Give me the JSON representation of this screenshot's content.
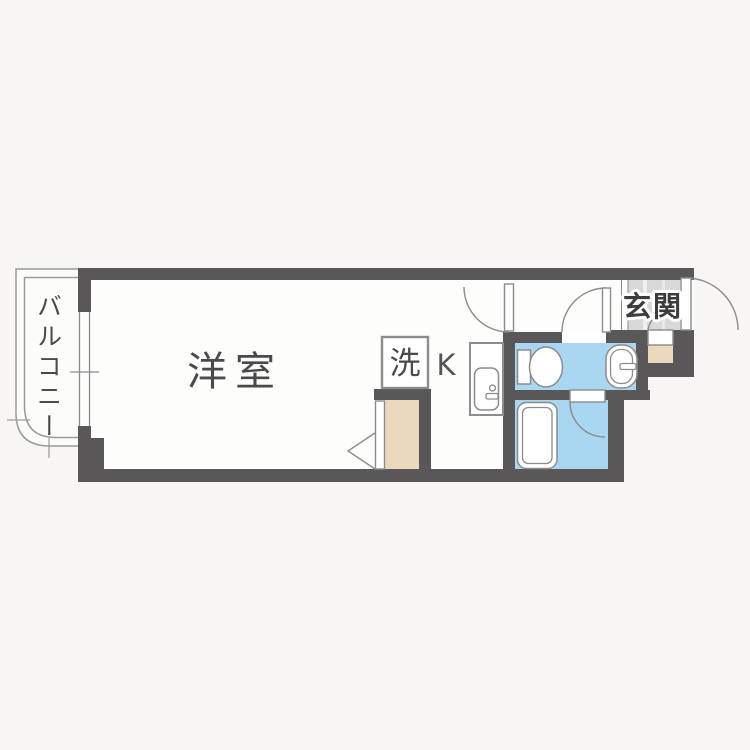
{
  "document": {
    "type": "apartment-floor-plan"
  },
  "labels": {
    "main_room": "洋室",
    "balcony": "バルコニー",
    "entrance": "玄関",
    "laundry": "洗",
    "kitchen": "K"
  },
  "colors": {
    "wall": "#595757",
    "water_area": "#a9d6f0",
    "wood_area": "#ebd9bd",
    "entrance_tile": "#d9d9d9",
    "line": "#8c8c8c",
    "text": "#4a4a4a",
    "background": "#f7f6f4",
    "floor": "#fdfdfc"
  }
}
